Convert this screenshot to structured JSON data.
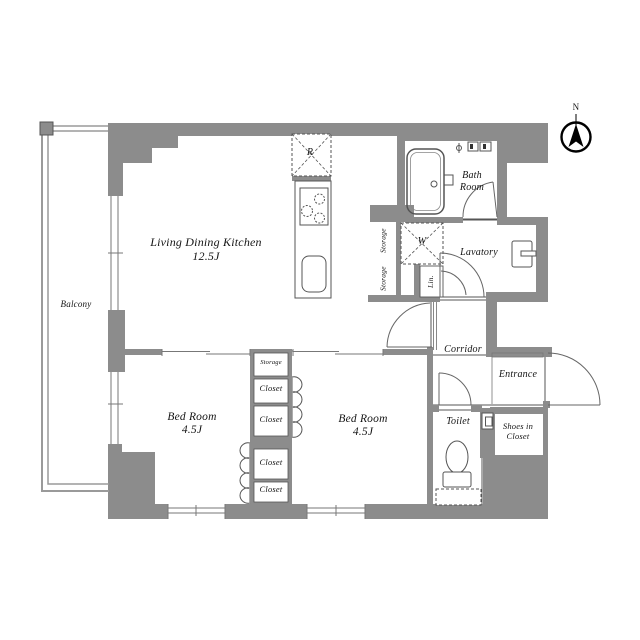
{
  "compass": {
    "label": "N"
  },
  "rooms": {
    "living_dining_kitchen": {
      "name": "Living Dining Kitchen",
      "size": "12.5J"
    },
    "balcony": {
      "name": "Balcony"
    },
    "bedroom_west": {
      "name": "Bed Room",
      "size": "4.5J"
    },
    "bedroom_east": {
      "name": "Bed Room",
      "size": "4.5J"
    },
    "bath_room": {
      "name_line1": "Bath",
      "name_line2": "Room"
    },
    "lavatory": {
      "name": "Lavatory"
    },
    "corridor": {
      "name": "Corridor"
    },
    "entrance": {
      "name": "Entrance"
    },
    "toilet": {
      "name": "Toilet"
    },
    "shoes_in_closet": {
      "name_line1": "Shoes in",
      "name_line2": "Closet"
    }
  },
  "fixtures": {
    "refrigerator_label": "R",
    "washing_machine_label": "W",
    "linen_label": "Lin.",
    "kitchen_storage_upper": "Storage",
    "kitchen_storage_lower": "Storage"
  },
  "closet_column": {
    "storage": "Storage",
    "closets": [
      "Closet",
      "Closet",
      "Closet",
      "Closet"
    ]
  },
  "colors": {
    "wall_fill": "#8c8c8c",
    "line": "#4a4a4a",
    "railing": "#9a9a9a",
    "text": "#111111"
  }
}
